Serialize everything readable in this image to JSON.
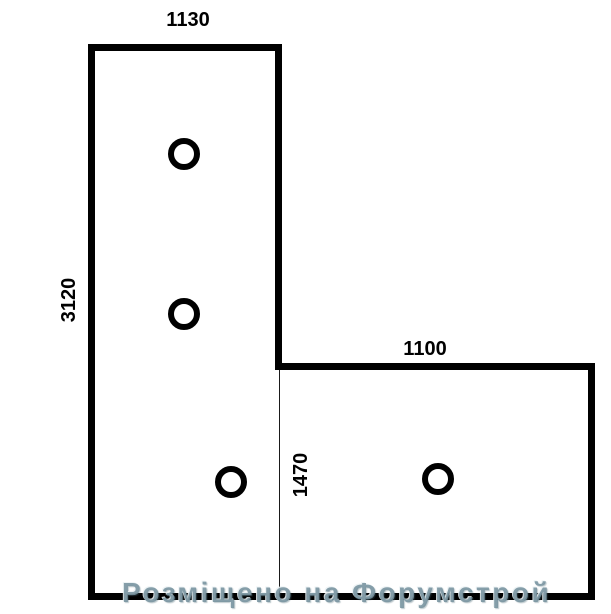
{
  "diagram": {
    "type": "L-shaped plan with hole markers",
    "canvas": {
      "width": 611,
      "height": 614
    },
    "outline": {
      "path": "M 91.5 47.5 H 278.5 V 366.5 H 591.5 V 596.5 H 91.5 Z",
      "stroke_color": "#000000",
      "stroke_width": 7,
      "fill": "#ffffff"
    },
    "divider_line": {
      "x": 279.5,
      "y1": 370,
      "y2": 593,
      "stroke_color": "#1a1a1a",
      "stroke_width": 1
    },
    "dimensions": [
      {
        "label": "1130",
        "edge": "top-width"
      },
      {
        "label": "3120",
        "edge": "left-height"
      },
      {
        "label": "1100",
        "edge": "right-section-width"
      },
      {
        "label": "1470",
        "edge": "right-section-height"
      }
    ],
    "holes": [
      {
        "cx": 184,
        "cy": 154
      },
      {
        "cx": 184,
        "cy": 314
      },
      {
        "cx": 231,
        "cy": 482
      },
      {
        "cx": 438,
        "cy": 479
      }
    ],
    "hole_style": {
      "radius": 13,
      "stroke_color": "#000000",
      "stroke_width": 6,
      "fill": "#ffffff"
    }
  },
  "watermark": {
    "text": "Розміщено на Форумстрой",
    "color": "#76929e"
  }
}
